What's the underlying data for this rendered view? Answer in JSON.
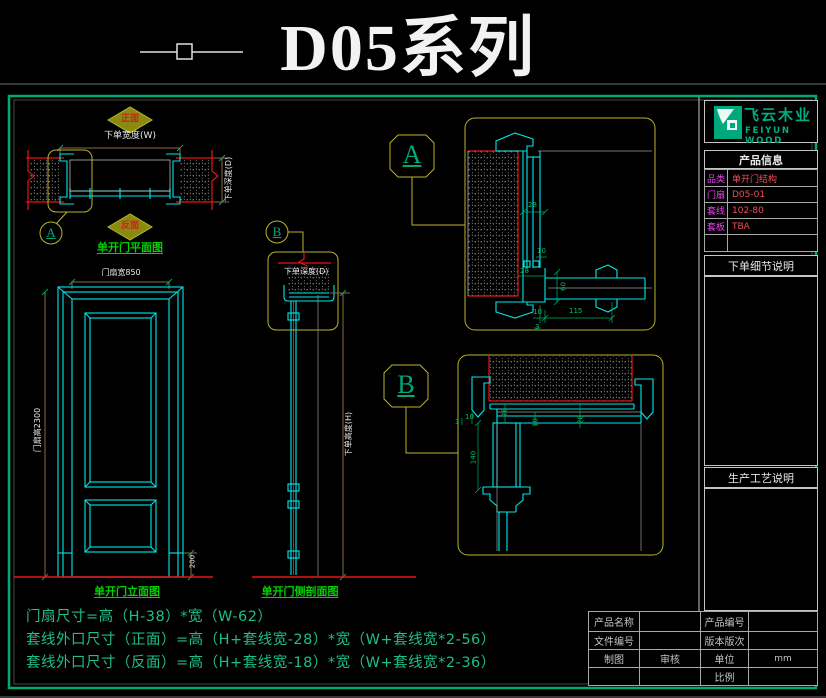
{
  "title": {
    "text": "D05系列"
  },
  "plan_view": {
    "front_label": "正面",
    "back_label": "反面",
    "width_label": "下单宽度(W)",
    "depth_label": "下单深度(D)",
    "callout": "A",
    "caption": "单开门平面图"
  },
  "elevation": {
    "width_dim": "门扇宽850",
    "height_dim": "门扇高2300",
    "bottom_dim": "200",
    "caption": "单开门立面图"
  },
  "side_section": {
    "callout": "B",
    "depth_label": "下单深度(D)",
    "height_label": "下单高度(H)",
    "caption": "单开门侧剖面图"
  },
  "detail_a": {
    "label": "A",
    "dims": {
      "d28a": "28",
      "d10a": "10",
      "d28b": "28",
      "d60": "60",
      "d10b": "10",
      "d115": "115",
      "d3": "3"
    }
  },
  "detail_b": {
    "label": "B",
    "dims": {
      "d28a": "28",
      "d10a": "10",
      "d3": "3",
      "d140": "140",
      "d10b": "10",
      "d28b": "28"
    }
  },
  "brand": {
    "name_cn": "飞云木业",
    "name_en": "FEIYUN WOOD"
  },
  "product_info": {
    "title": "产品信息",
    "rows": [
      {
        "label": "品类",
        "value": "单开门结构"
      },
      {
        "label": "门扇",
        "value": "D05-01"
      },
      {
        "label": "套线",
        "value": "102-80"
      },
      {
        "label": "套板",
        "value": "TBA"
      }
    ]
  },
  "notes": {
    "order_detail_title": "下单细节说明",
    "process_title": "生产工艺说明"
  },
  "title_block": {
    "product_name_label": "产品名称",
    "product_no_label": "产品编号",
    "file_no_label": "文件编号",
    "version_label": "版本版次",
    "draft_label": "制图",
    "review_label": "审核",
    "unit_label": "单位",
    "unit_value": "mm",
    "scale_label": "比例"
  },
  "formulas": {
    "line1": "门扇尺寸=高（H-38）*宽（W-62）",
    "line2": "套线外口尺寸（正面）=高（H+套线宽-28）*宽（W+套线宽*2-56）",
    "line3": "套线外口尺寸（反面）=高（H+套线宽-18）*宽（W+套线宽*2-36）"
  },
  "colors": {
    "line_cyan": "#00e8e8",
    "line_red": "#e81414",
    "callout_olive": "#b8b428",
    "label_green": "#00d200",
    "brand_teal": "#00ad80",
    "info_magenta": "#f040f0",
    "info_value_red": "#f05058",
    "dim_brown": "#8a6a4a",
    "formula_green": "#1fbd8a"
  }
}
